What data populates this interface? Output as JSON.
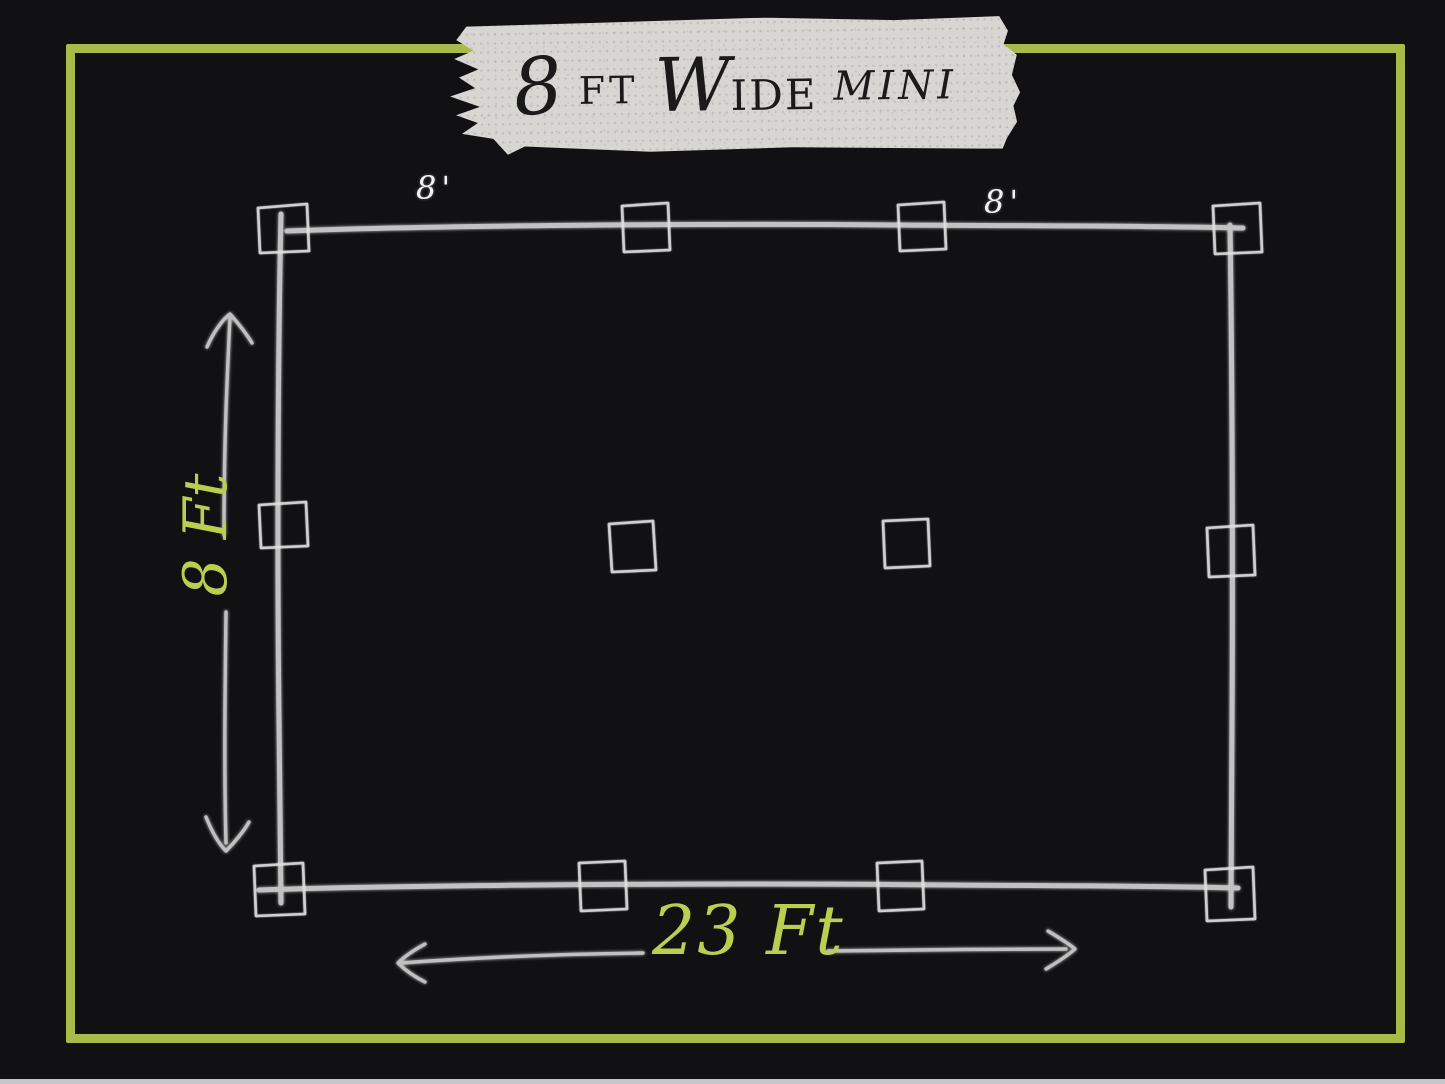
{
  "tape": {
    "full_label": "8 FT WIDE MINI",
    "parts": {
      "number": "8",
      "ft": "FT",
      "w": "W",
      "ide": "IDE",
      "mini": "MINI"
    }
  },
  "dimensions": {
    "top_left_span": "8'",
    "top_right_span": "8'",
    "height": "8 Ft",
    "width": "23 Ft"
  },
  "structure": {
    "description": "hand-sketched rectangular frame plan",
    "post_count": 12,
    "posts_per_row": 4,
    "rows": [
      "top",
      "middle",
      "bottom"
    ]
  },
  "colors": {
    "background": "#111113",
    "frame_green": "#a8bb49",
    "handwriting_green": "#b9cf50",
    "sketch_white": "#dadada",
    "tape_fill": "#d8d6d2",
    "tape_text": "#1a1a1a",
    "bottom_strip": "#c6c6c6"
  }
}
